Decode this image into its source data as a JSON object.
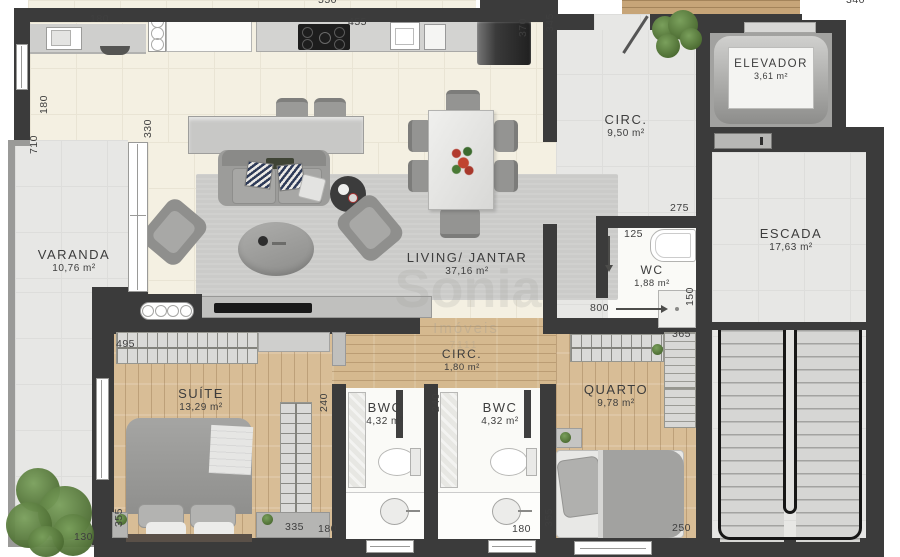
{
  "watermark": {
    "line1": "Sonia",
    "line2": "Imóveis",
    "line3": "7111"
  },
  "rooms": [
    {
      "name": "VARANDA",
      "area": "10,76 m²"
    },
    {
      "name": "LIVING/ JANTAR",
      "area": "37,16 m²"
    },
    {
      "name": "CIRC.",
      "area": "9,50 m²"
    },
    {
      "name": "ELEVADOR",
      "area": "3,61 m²"
    },
    {
      "name": "ESCADA",
      "area": "17,63 m²"
    },
    {
      "name": "WC",
      "area": "1,88 m²"
    },
    {
      "name": "CIRC.",
      "area": "1,80 m²"
    },
    {
      "name": "SUÍTE",
      "area": "13,29 m²"
    },
    {
      "name": "BWC",
      "area": "4,32 m²"
    },
    {
      "name": "BWC",
      "area": "4,32 m²"
    },
    {
      "name": "QUARTO",
      "area": "9,78 m²"
    }
  ],
  "dims": [
    {
      "value": "180"
    },
    {
      "value": "455"
    },
    {
      "value": "370"
    },
    {
      "value": "345"
    },
    {
      "value": "180"
    },
    {
      "value": "710"
    },
    {
      "value": "330"
    },
    {
      "value": "275"
    },
    {
      "value": "125"
    },
    {
      "value": "800"
    },
    {
      "value": "150"
    },
    {
      "value": "495"
    },
    {
      "value": "365"
    },
    {
      "value": "240"
    },
    {
      "value": "240"
    },
    {
      "value": "355"
    },
    {
      "value": "335"
    },
    {
      "value": "130"
    },
    {
      "value": "180"
    },
    {
      "value": "180"
    },
    {
      "value": "355"
    },
    {
      "value": "250"
    },
    {
      "value": "550"
    },
    {
      "value": "340"
    }
  ]
}
